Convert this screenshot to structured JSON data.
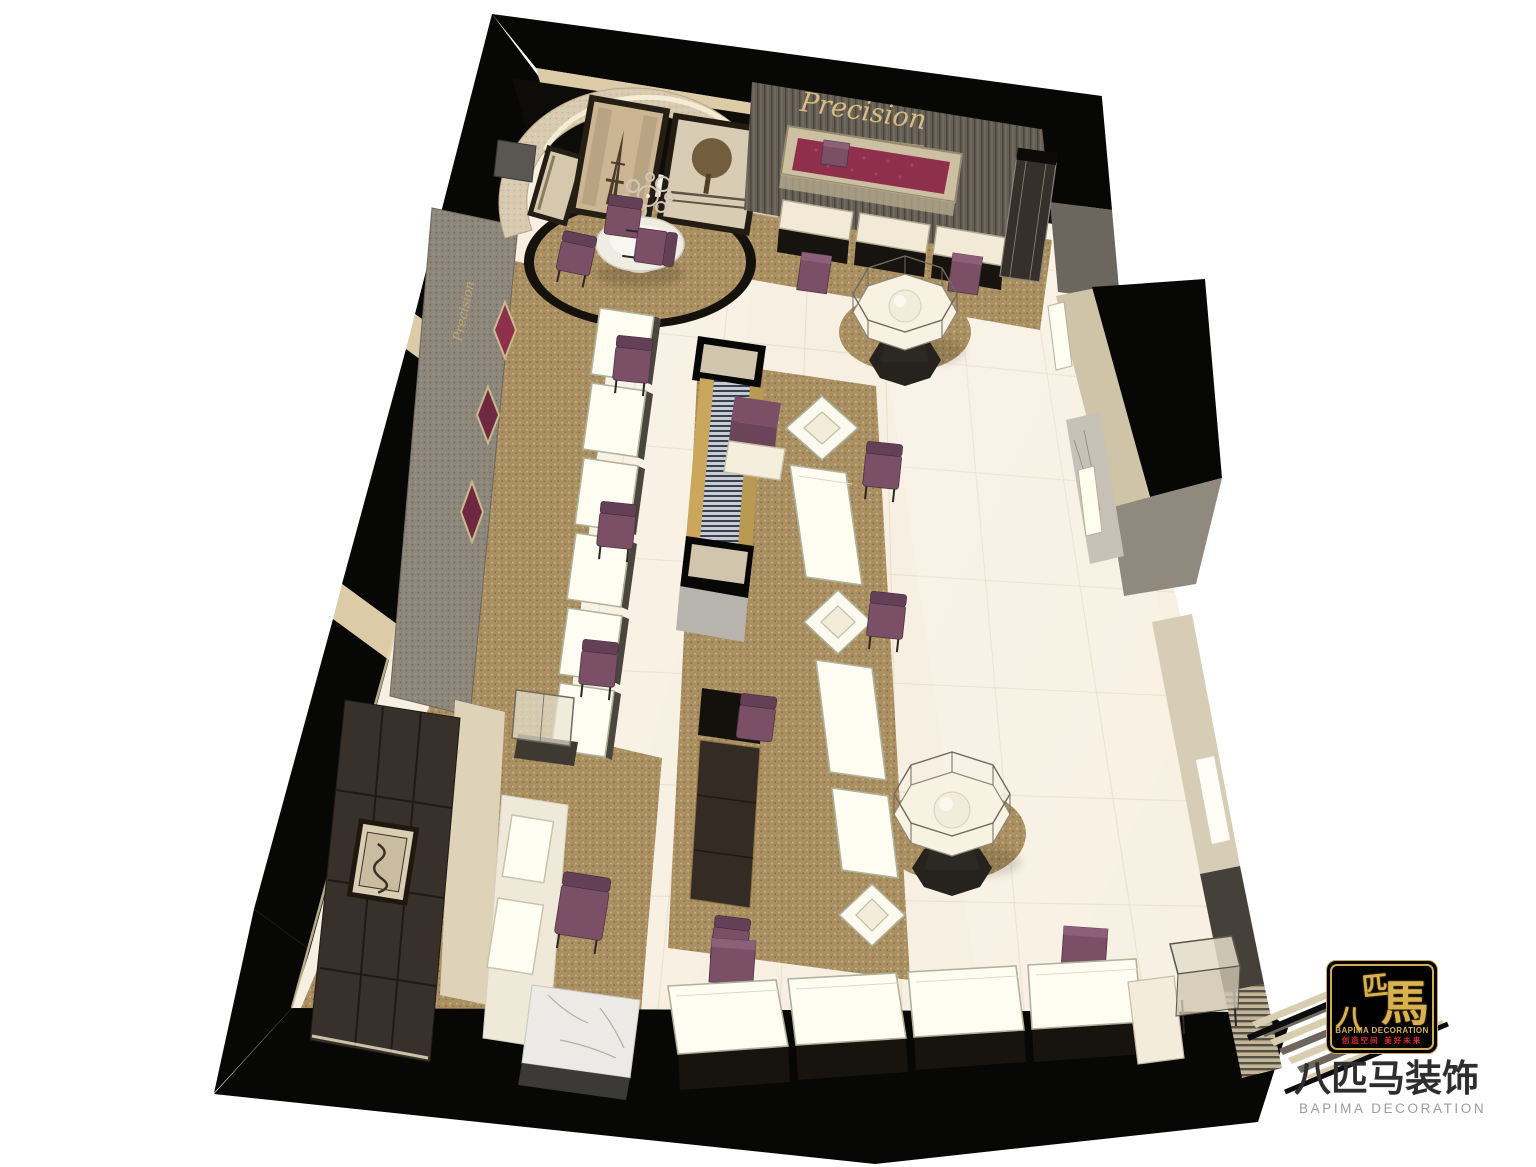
{
  "signs": {
    "back_wall": "Precision",
    "left_wall": "Precision"
  },
  "logo": {
    "char_top": "匹",
    "char_right": "馬",
    "char_bottom": "八",
    "name": "BAPIMA DECORATION",
    "tagline": "创造空间 美好未来"
  },
  "watermark": {
    "cjk": "八匹马装饰",
    "latin": "BAPIMA DECORATION"
  },
  "colors": {
    "floor": "#f7f0e2",
    "carpet": "#a98f61",
    "wall_black": "#070706",
    "textured_wall": "#8d867a",
    "alcove_wall": "#d8cab0",
    "magenta_niche": "#8e2f4c",
    "chair_purple": "#7b5066",
    "counter_glow": "#fffdf2",
    "gold": "#c9a44c",
    "logo_gold": "#d9b14e",
    "logo_red": "#e03030",
    "marble": "#ecebe7"
  }
}
